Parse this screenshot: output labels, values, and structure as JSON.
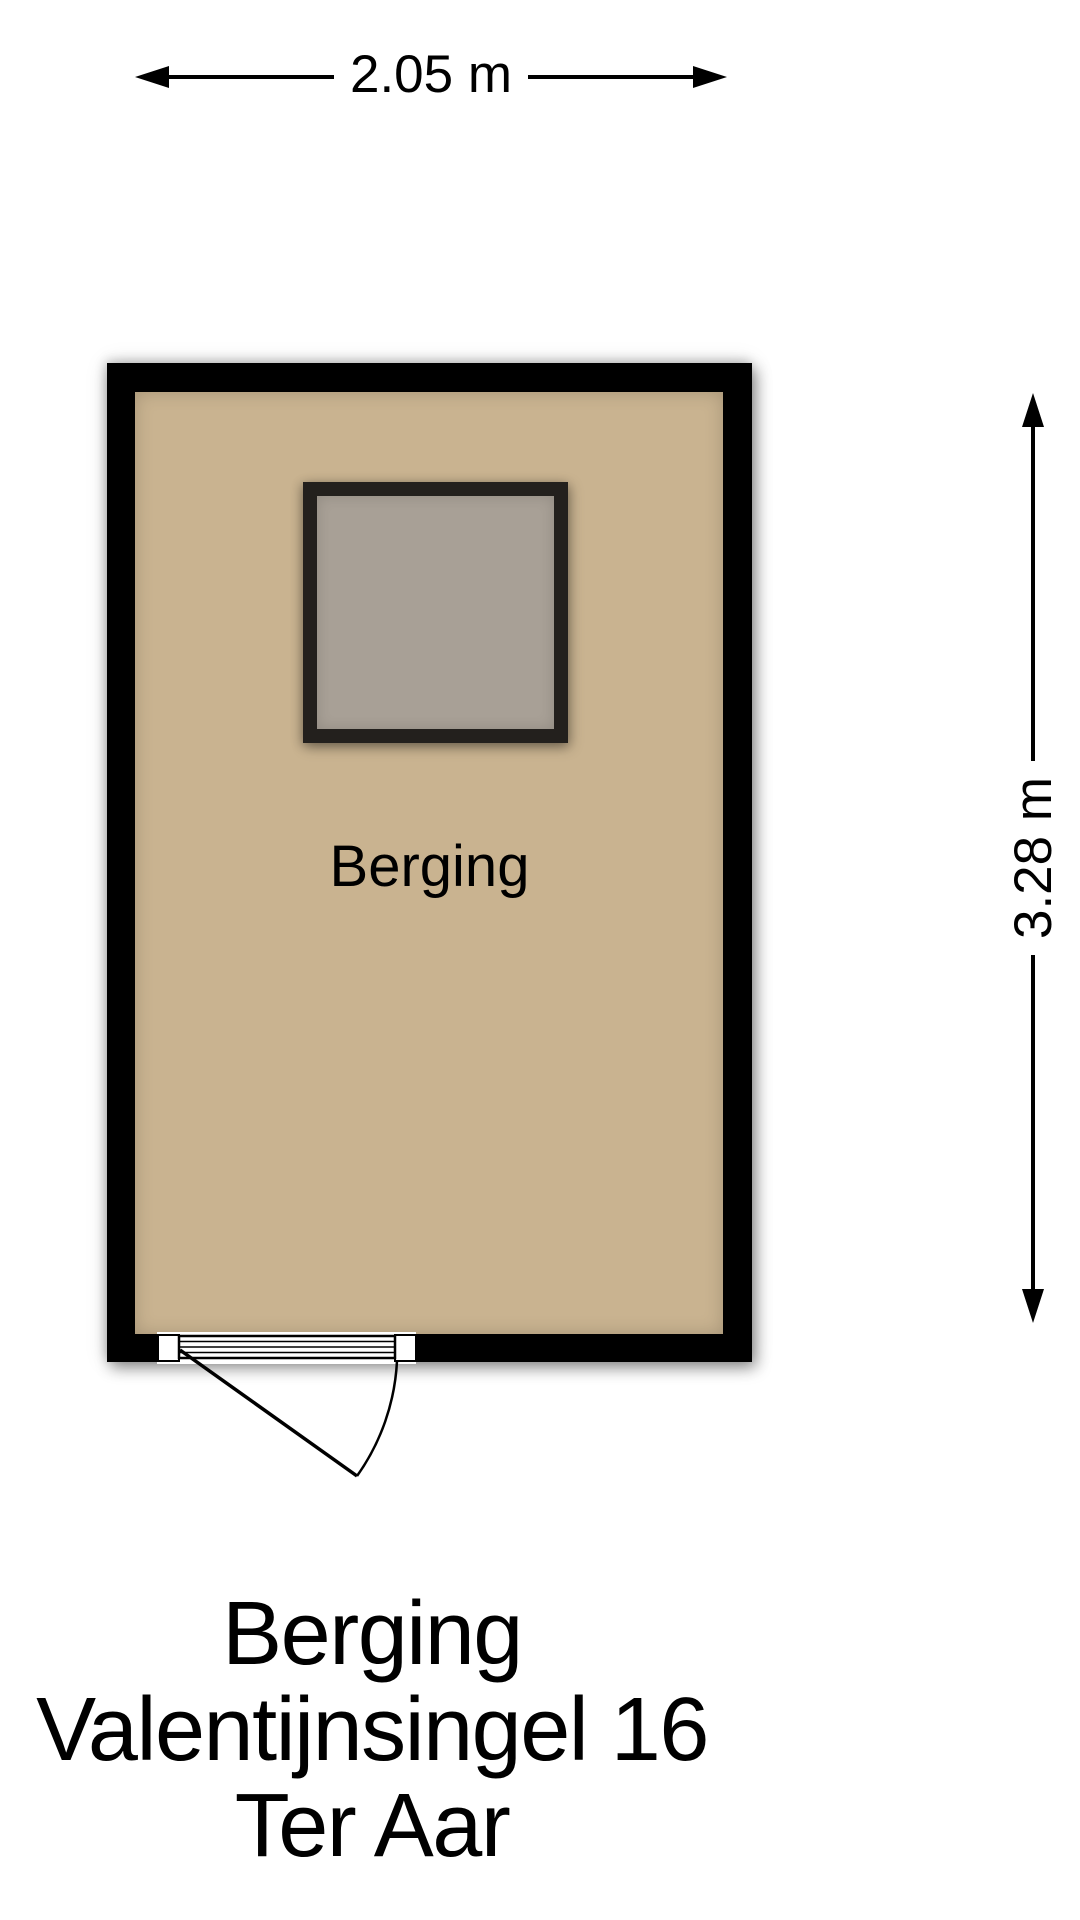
{
  "dimensions": {
    "width_label": "2.05 m",
    "height_label": "3.28 m"
  },
  "room": {
    "label": "Berging"
  },
  "caption": {
    "line1": "Berging",
    "line2": "Valentijnsingel 16",
    "line3": "Ter Aar"
  },
  "colors": {
    "background": "#ffffff",
    "wall": "#000000",
    "floor": "#c9b390",
    "object_border": "#23201d",
    "object_fill": "#a8a096",
    "text": "#000000"
  }
}
